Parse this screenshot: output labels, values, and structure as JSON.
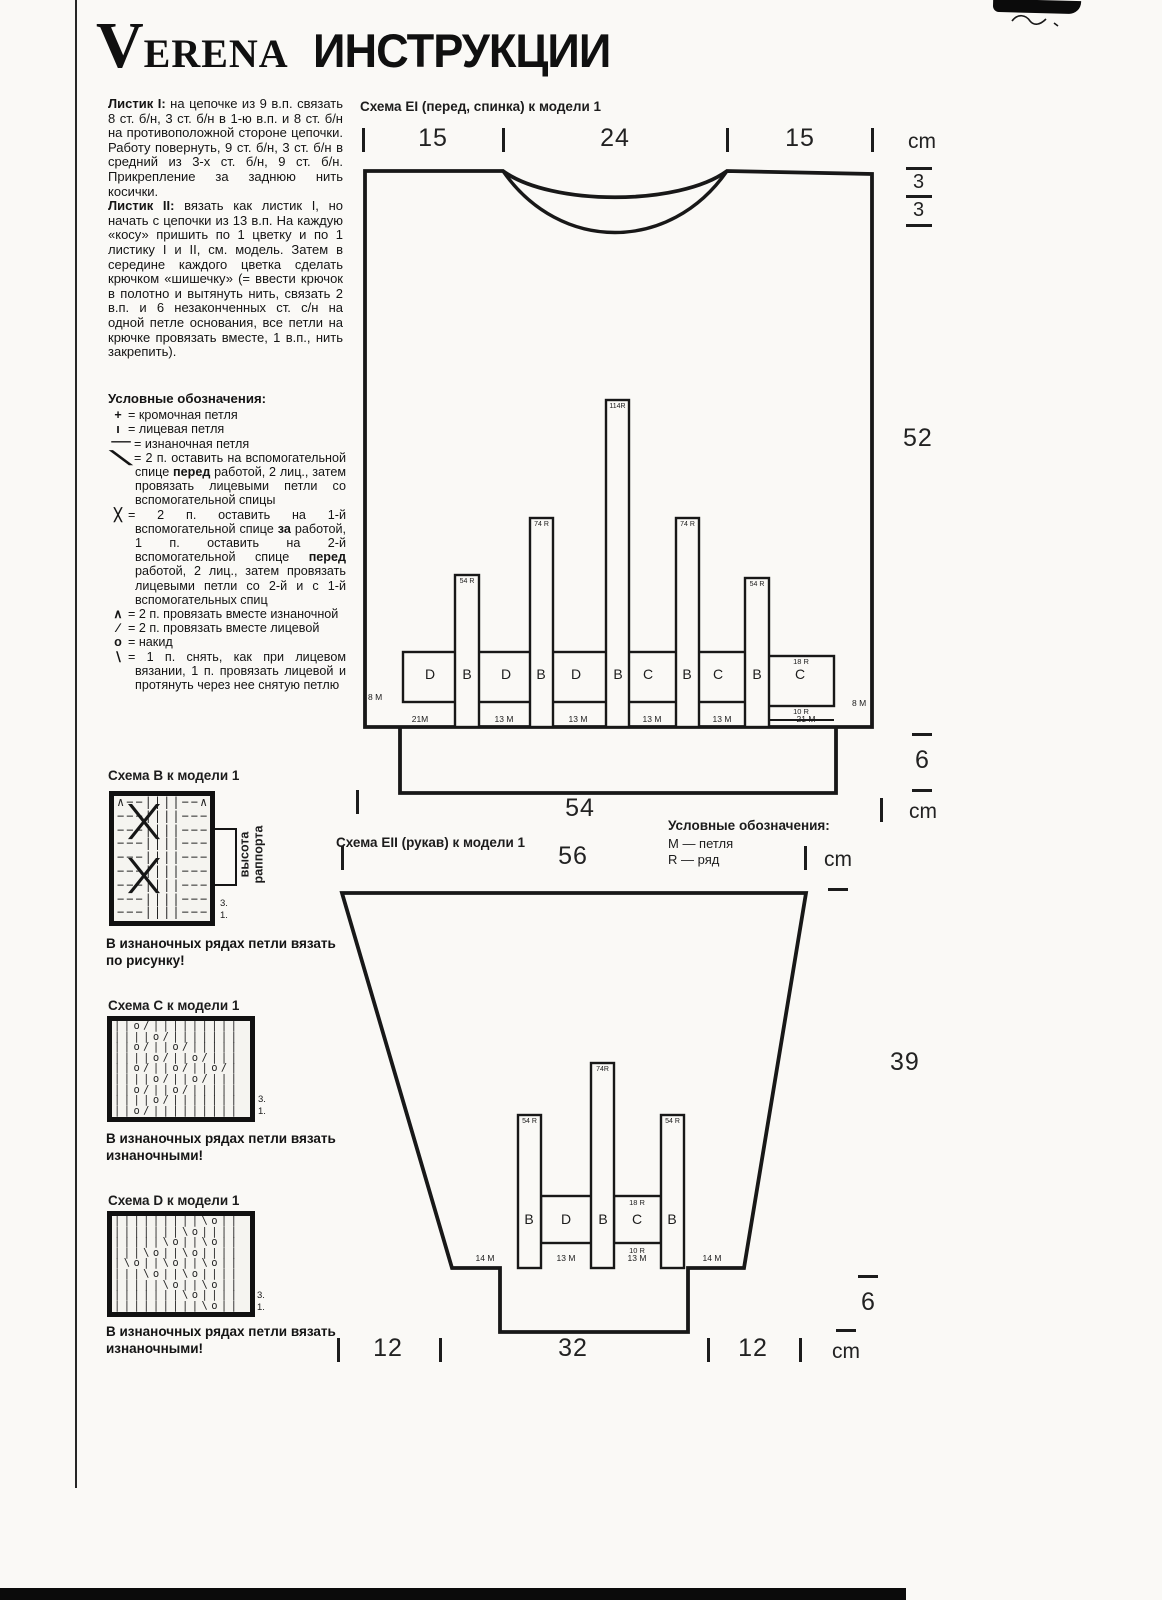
{
  "page": {
    "brand_initial": "V",
    "brand_rest": "ERENA",
    "title": "ИНСТРУКЦИИ"
  },
  "instructions": {
    "para1_lead": "Листик I:",
    "para1_text": " на цепочке из 9 в.п. связать 8 ст. б/н, 3 ст. б/н в 1-ю в.п. и 8 ст. б/н на противоположной стороне цепочки. Работу повернуть, 9 ст. б/н, 3 ст. б/н в средний из 3-х ст. б/н, 9 ст. б/н. Прикрепление за заднюю нить косички.",
    "para2_lead": "Листик II:",
    "para2_text": " вязать как листик I, но начать с цепочки из 13 в.п. На каждую «косу» пришить по 1 цветку и по 1 листику I и II, см. модель. Затем в середине каждого цветка сделать крючком «шишечку» (= ввести крючок в полотно и вытянуть нить, связать 2 в.п. и 6 незаконченных ст. с/н на одной петле основания, все петли на крючке провязать вместе, 1 в.п., нить закрепить)."
  },
  "legend": {
    "header": "Условные обозначения:",
    "items": [
      {
        "sym": "+",
        "t1": "= кромочная петля"
      },
      {
        "sym": "ı",
        "t1": "= лицевая петля"
      },
      {
        "sym": "−",
        "t1": "= изнаночная петля"
      },
      {
        "sym": "╲",
        "t1": "= 2 п. оставить на вспомогательной спице ",
        "b1": "перед",
        "t2": " работой, 2 лиц., затем провязать лицевыми петли со вспомогательной спицы"
      },
      {
        "sym": "╳",
        "t1": "= 2 п. оставить на 1-й вспомогательной спице ",
        "b1": "за",
        "t2": " работой, 1 п. оставить на 2-й вспомогательной спице ",
        "b2": "перед",
        "t3": " работой, 2 лиц., затем провязать лицевыми петли со 2-й и с 1-й вспомогательных спиц"
      },
      {
        "sym": "∧",
        "t1": "= 2 п. провязать вместе изнаночной"
      },
      {
        "sym": "∕",
        "t1": "= 2 п. провязать вместе лицевой"
      },
      {
        "sym": "о",
        "t1": "= накид"
      },
      {
        "sym": "∖",
        "t1": "= 1 п. снять, как при лицевом вязании, 1 п. провязать лицевой и протянуть через нее снятую петлю"
      }
    ]
  },
  "charts": {
    "b": {
      "title": "Схема B к модели 1",
      "rows": [
        "∧−−||||−−∧",
        "−−−||||−−−",
        "−−−||||−−−",
        "−−−||||−−−",
        "−−−||||−−−",
        "−−−||||−−−",
        "−−−||||−−−",
        "−−−||||−−−",
        "−−−||||−−−"
      ],
      "cross_symbol": "╳",
      "bracket_label": "высота раппорта",
      "row3": "3.",
      "row1": "1.",
      "note": "В изнаночных рядах петли вязать по рисунку!"
    },
    "c": {
      "title": "Схема C к модели 1",
      "rows": [
        "||o/|||||||||",
        "||||o/|||||||",
        "||o/||o/|||||",
        "||||o/||o/|||",
        "||o/||o/||o/|",
        "||||o/||o/|||",
        "||o/||o/|||||",
        "||||o/|||||||",
        "||o/|||||||||"
      ],
      "row3": "3.",
      "row1": "1.",
      "note": "В изнаночных рядах петли вязать изнаночными!"
    },
    "d": {
      "title": "Схема D к модели 1",
      "rows": [
        "|||||||||\\o||",
        "|||||||\\o||||",
        "|||||\\o||\\o||",
        "|||\\o||\\o||||",
        "|\\o||\\o||\\o||",
        "|||\\o||\\o||||",
        "|||||\\o||\\o||",
        "|||||||\\o||||",
        "|||||||||\\o||"
      ],
      "row3": "3.",
      "row1": "1.",
      "note": "В изнаночных рядах петли вязать изнаночными!"
    }
  },
  "ei": {
    "title": "Схема EI (перед, спинка) к модели 1",
    "top": {
      "w1": "15",
      "w2": "24",
      "w3": "15",
      "unit": "cm"
    },
    "right": {
      "n3a": "3",
      "n3b": "3",
      "h_body": "52",
      "h_rib": "6",
      "unit": "cm"
    },
    "bottom": {
      "w": "54"
    },
    "bars": [
      {
        "label": "54 R"
      },
      {
        "label": "74 R"
      },
      {
        "label": "114R"
      },
      {
        "label": "74 R"
      },
      {
        "label": "54 R"
      }
    ],
    "band_letters": [
      "D",
      "B",
      "D",
      "B",
      "D",
      "B",
      "C",
      "B",
      "C",
      "B",
      "C"
    ],
    "band_right": {
      "top": "18 R",
      "bottom": "10 R"
    },
    "edge_left": "8 M",
    "edge_right": "8 M",
    "stitch_counts": [
      "21M",
      "13 M",
      "13 M",
      "13 M",
      "13 M",
      "21 M"
    ]
  },
  "legend2": {
    "header": "Условные обозначения:",
    "m": "M — петля",
    "r": "R — ряд"
  },
  "eii": {
    "title": "Схема EII (рукав) к модели 1",
    "top": {
      "w": "56",
      "unit": "cm"
    },
    "right": {
      "h_body": "39",
      "h_rib": "6",
      "unit": "cm"
    },
    "bars": [
      {
        "label": "54 R"
      },
      {
        "label": "74R"
      },
      {
        "label": "54 R"
      }
    ],
    "letters": [
      "B",
      "D",
      "B",
      "C",
      "B"
    ],
    "panel": {
      "top": "18 R",
      "bottom": "10 R"
    },
    "stitch_counts": [
      "14 M",
      "13 M",
      "13 M",
      "14 M"
    ],
    "bottom": {
      "w1": "12",
      "w2": "32",
      "w3": "12"
    }
  }
}
